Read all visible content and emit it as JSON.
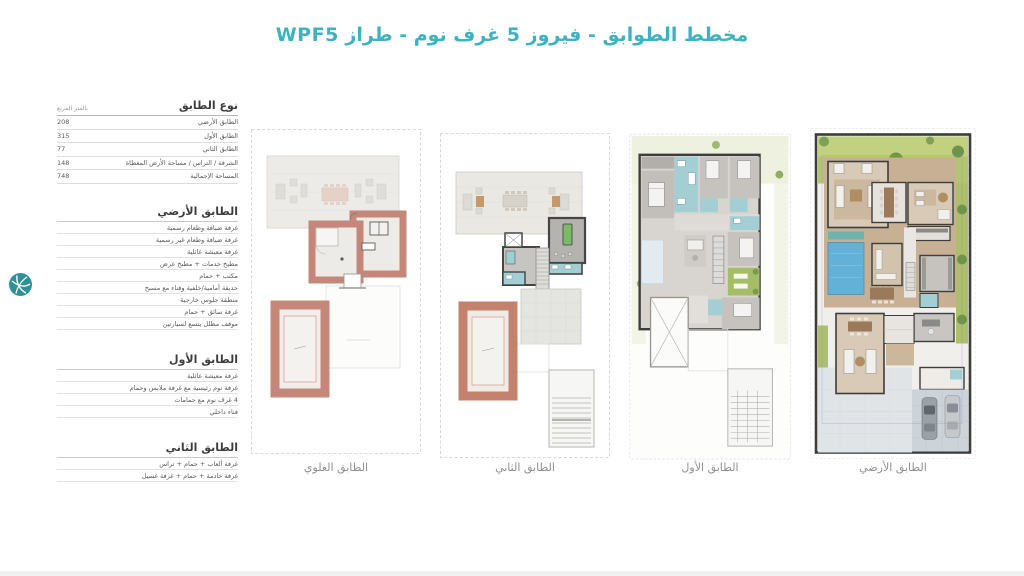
{
  "page": {
    "title": "مخطط الطوابق  - فيروز 5 غرف نوم - طراز WPF5",
    "accent_color": "#3eb3bf"
  },
  "area_table": {
    "header": {
      "type_label": "نوع الطابق",
      "unit_label": "بالمتر المربع"
    },
    "rows": [
      {
        "label": "الطابق الأرضي",
        "value": "208"
      },
      {
        "label": "الطابق الأول",
        "value": "315"
      },
      {
        "label": "الطابق الثاني",
        "value": "77"
      },
      {
        "label": "الشرفة / التراس / مساحة الأرض المغطاة",
        "value": "148"
      },
      {
        "label": "المساحة الإجمالية",
        "value": "748"
      }
    ]
  },
  "sections": [
    {
      "title": "الطابق الأرضي",
      "items": [
        "غرفة ضيافة وطعام رسمية",
        "غرفة ضيافة وطعام غير رسمية",
        "غرفة معيشة عائلية",
        "مطبخ خدمات + مطبخ عرض",
        "مكتب + حمام",
        "حديقة أمامية/خلفية وفناء مع مسبح",
        "منطقة جلوس خارجية",
        "غرفة سائق + حمام",
        "موقف مظلل يتسع لسيارتين"
      ]
    },
    {
      "title": "الطابق الأول",
      "items": [
        "غرفة معيشة عائلية",
        "غرفة نوم رئيسية مع غرفة ملابس وحمام",
        "4 غرف نوم مع حمامات",
        "فناء داخلي"
      ]
    },
    {
      "title": "الطابق الثاني",
      "items": [
        "غرفة ألعاب + حمام + تراس",
        "غرفة خادمة + حمام + غرفة غسيل"
      ]
    }
  ],
  "plans": [
    {
      "label": "الطابق العلوي"
    },
    {
      "label": "الطابق الثاني"
    },
    {
      "label": "الطابق الأول"
    },
    {
      "label": "الطابق الأرضي"
    }
  ],
  "colors": {
    "roof_salmon": "#c4877a",
    "roof_deck": "#ecebe7",
    "bathroom_teal": "#a3cfd4",
    "courtyard_green": "#a6bd68",
    "garden_green": "#b3c56e",
    "pool_blue": "#63b1d6",
    "deck_tan": "#c8b094",
    "driveway_gray": "#ccd3d9",
    "wall_dark": "#3d3d3b"
  }
}
